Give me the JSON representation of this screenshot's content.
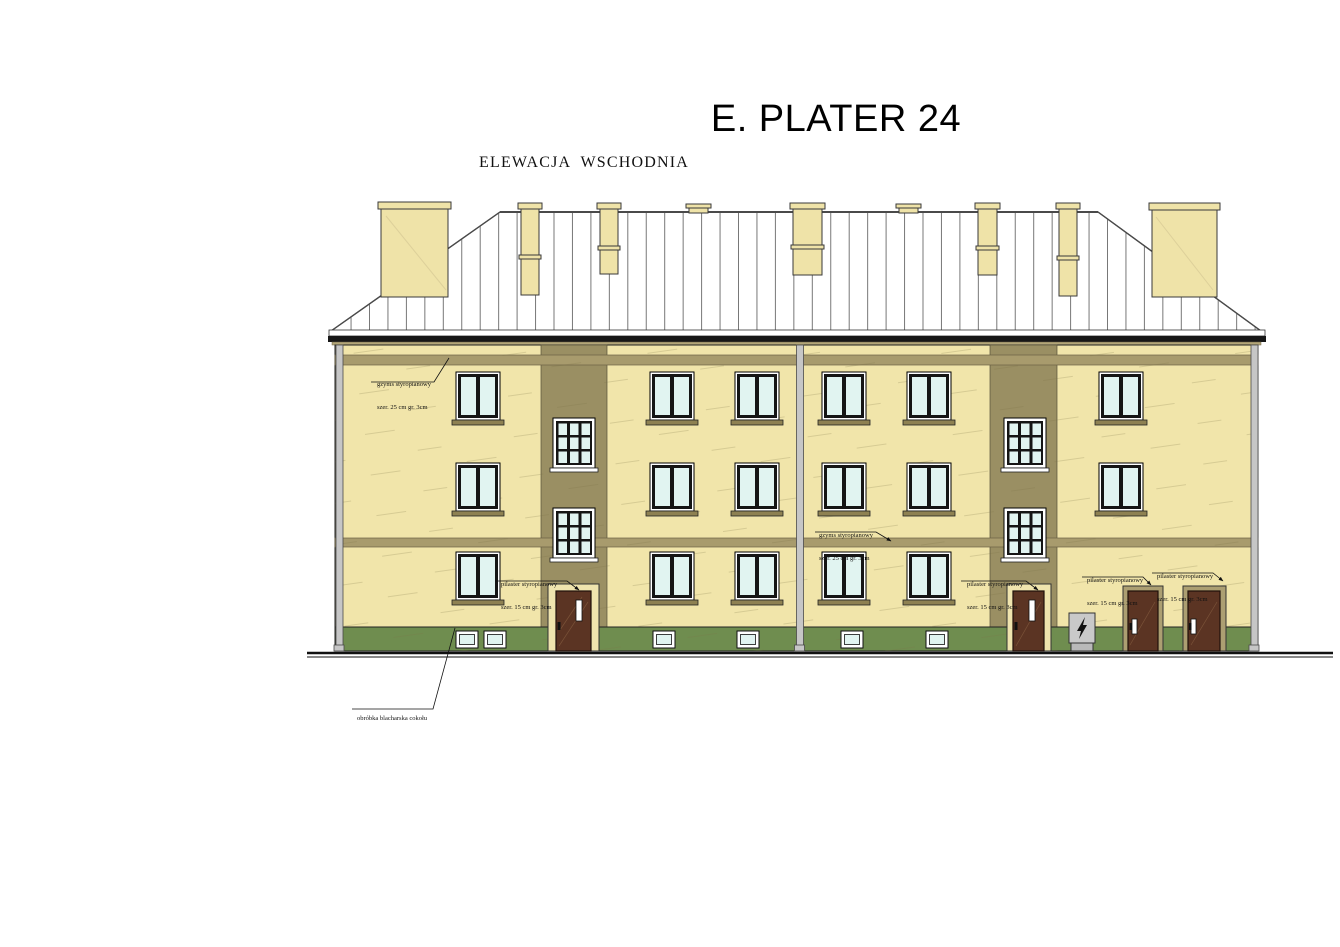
{
  "title": "E. PLATER 24",
  "subtitle": "ELEWACJA  WSCHODNIA",
  "annotations": [
    {
      "id": "gzyms-top",
      "line1": "gzyms styropianowy",
      "line2": "szer. 25 cm gr. 3cm"
    },
    {
      "id": "gzyms-mid",
      "line1": "gzyms styropianowy",
      "line2": "szer. 25 cm gr. 3cm"
    },
    {
      "id": "pilaster-door-1",
      "line1": "pilaster styropianowy",
      "line2": "szer. 15 cm gr. 3cm"
    },
    {
      "id": "pilaster-door-2",
      "line1": "pilaster styropianowy",
      "line2": "szer. 15 cm gr. 3cm"
    },
    {
      "id": "pilaster-door-3",
      "line1": "pilaster styropianowy",
      "line2": "szer. 15 cm gr. 3cm"
    },
    {
      "id": "pilaster-door-4",
      "line1": "pilaster styropianowy",
      "line2": "szer. 15 cm gr. 3cm"
    },
    {
      "id": "cokol-flashing",
      "line1": "obróbka blacharska cokołu",
      "line2": ""
    }
  ],
  "colors": {
    "facade": "#F1E5AA",
    "cornice_band": "#A89B6D",
    "stairwell_strip": "#9A8F63",
    "plinth_green": "#6F8D4F",
    "roof_white": "#FFFFFF",
    "roof_seam": "#777777",
    "chimney_cream": "#EFE3A8",
    "window_glass": "#E1F4F1",
    "window_frame": "#151515",
    "door_brown": "#5B3423",
    "door_surround_cream": "#EFE4AE",
    "door_surround_tan": "#AC9F72",
    "downpipe_gray": "#C6C6C6",
    "eaves_gutter": "#161616",
    "ground_line": "#111111"
  }
}
